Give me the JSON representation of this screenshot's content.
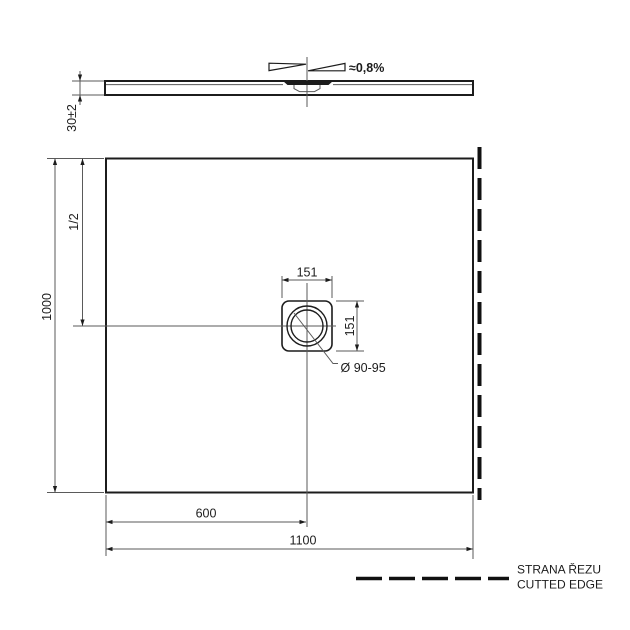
{
  "side_view": {
    "thickness_dim": "30±2",
    "slope_dim": "≈0,8%"
  },
  "top_view": {
    "height_dim": "1000",
    "half_height_dim": "1/2",
    "drain_width_dim": "151",
    "drain_height_dim": "151",
    "drain_diameter_dim": "Ø 90-95",
    "drain_offset_dim": "600",
    "width_dim": "1100"
  },
  "legend": {
    "label_cs": "STRANA ŘEZU",
    "label_en": "CUTTED EDGE"
  },
  "colors": {
    "line": "#1c1c1c",
    "thin_line": "#5a5a5a",
    "background": "#ffffff"
  }
}
